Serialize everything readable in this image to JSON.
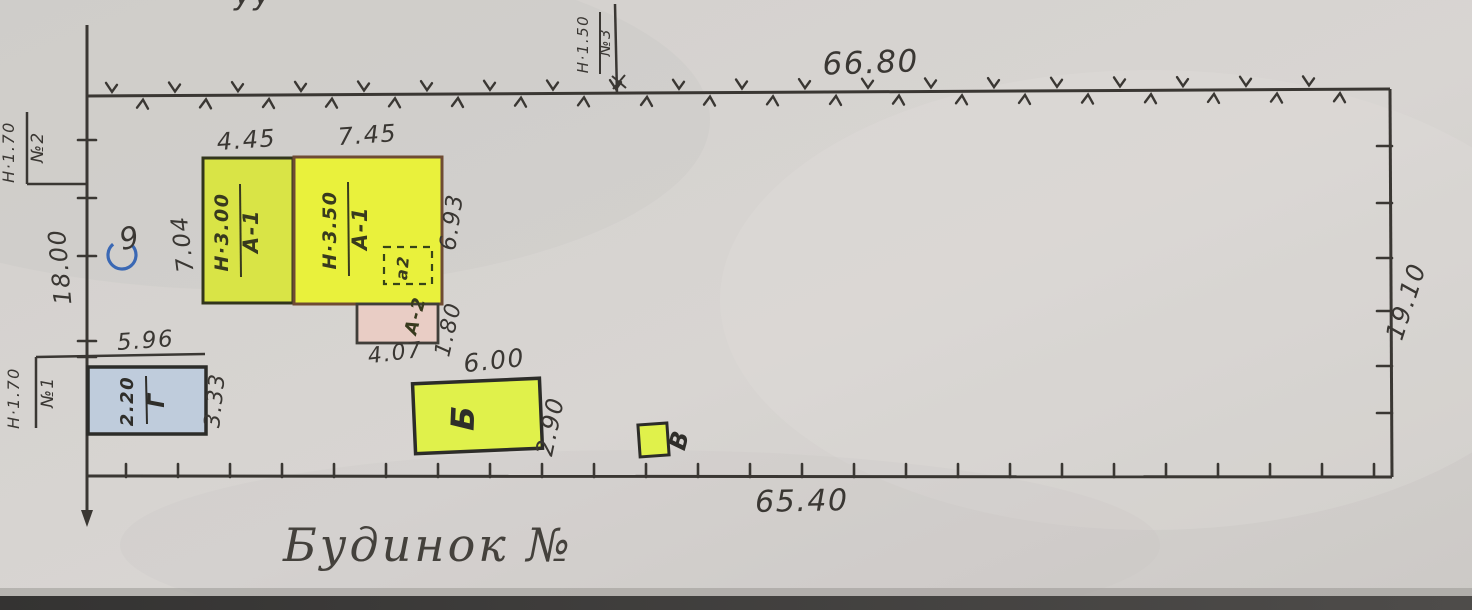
{
  "palette": {
    "paper": "#d5d2cf",
    "ink": "#3a3733",
    "building_a_left_fill": "#d9e446",
    "building_a_left_stroke": "#32351c",
    "building_a_main_fill": "#e9f13c",
    "building_a_main_stroke": "#6e4b33",
    "annex_fill": "#e9cdc5",
    "outbuilding_fill": "#e0f14b",
    "building_g_fill": "#bfccdc",
    "blue_pen": "#3a68b4"
  },
  "caption": "Будинок №",
  "boundary": {
    "top": "66.80",
    "bottom": "65.40",
    "left": "18.00",
    "right": "19.10"
  },
  "markers": [
    {
      "num": "№1",
      "height": "Н·1.70"
    },
    {
      "num": "№2",
      "height": "Н·1.70"
    },
    {
      "num": "№3",
      "height": "Н·1.50"
    }
  ],
  "buildings": {
    "a1_left": {
      "label": "А-1",
      "height": "Н·3.00",
      "width": "4.45",
      "depth": "7.04"
    },
    "a1_main": {
      "label": "А-1",
      "height": "Н·3.50",
      "width": "7.45",
      "depth": "6.93"
    },
    "annex_a2": {
      "label": "А-2",
      "width": "4.07",
      "depth": "1.80"
    },
    "porch_a2": {
      "label": "а2"
    },
    "b": {
      "label": "Б",
      "width": "6.00",
      "depth": "2.90"
    },
    "v": {
      "label": "В"
    },
    "g": {
      "label": "Г",
      "height": "2.20",
      "width": "5.96",
      "depth": "3.33"
    }
  },
  "annotations": {
    "circled_mark": "9",
    "cut_text_top": "уу"
  }
}
